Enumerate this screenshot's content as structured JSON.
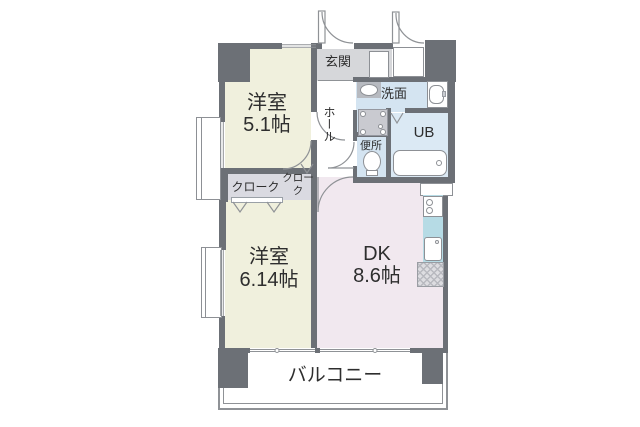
{
  "floorplan": {
    "rooms": [
      {
        "label": "洋室",
        "area": "5.1帖"
      },
      {
        "label": "洋室",
        "area": "6.14帖"
      },
      {
        "label": "DK",
        "area": "8.6帖"
      }
    ],
    "entrance": {
      "label": "玄関"
    },
    "hall": {
      "label": "ホール"
    },
    "washroom": {
      "label": "洗面"
    },
    "unit_bath": {
      "label": "UB"
    },
    "toilet": {
      "label": "便所"
    },
    "closets": [
      {
        "label": "クローク"
      },
      {
        "label": "クローク"
      }
    ],
    "balcony": {
      "label": "バルコニー"
    },
    "colors": {
      "wall": "#6c7076",
      "bedroom_floor": "#f0f0dd",
      "dk_floor": "#f1e8ef",
      "closet_floor": "#dadae1",
      "entrance_floor": "#d6d7da",
      "wet_area_floor": "#d4e4f1",
      "unit_bath_floor": "#dbe9f4",
      "kitchen_counter": "#b6dbe5",
      "line": "#8f9296"
    }
  }
}
